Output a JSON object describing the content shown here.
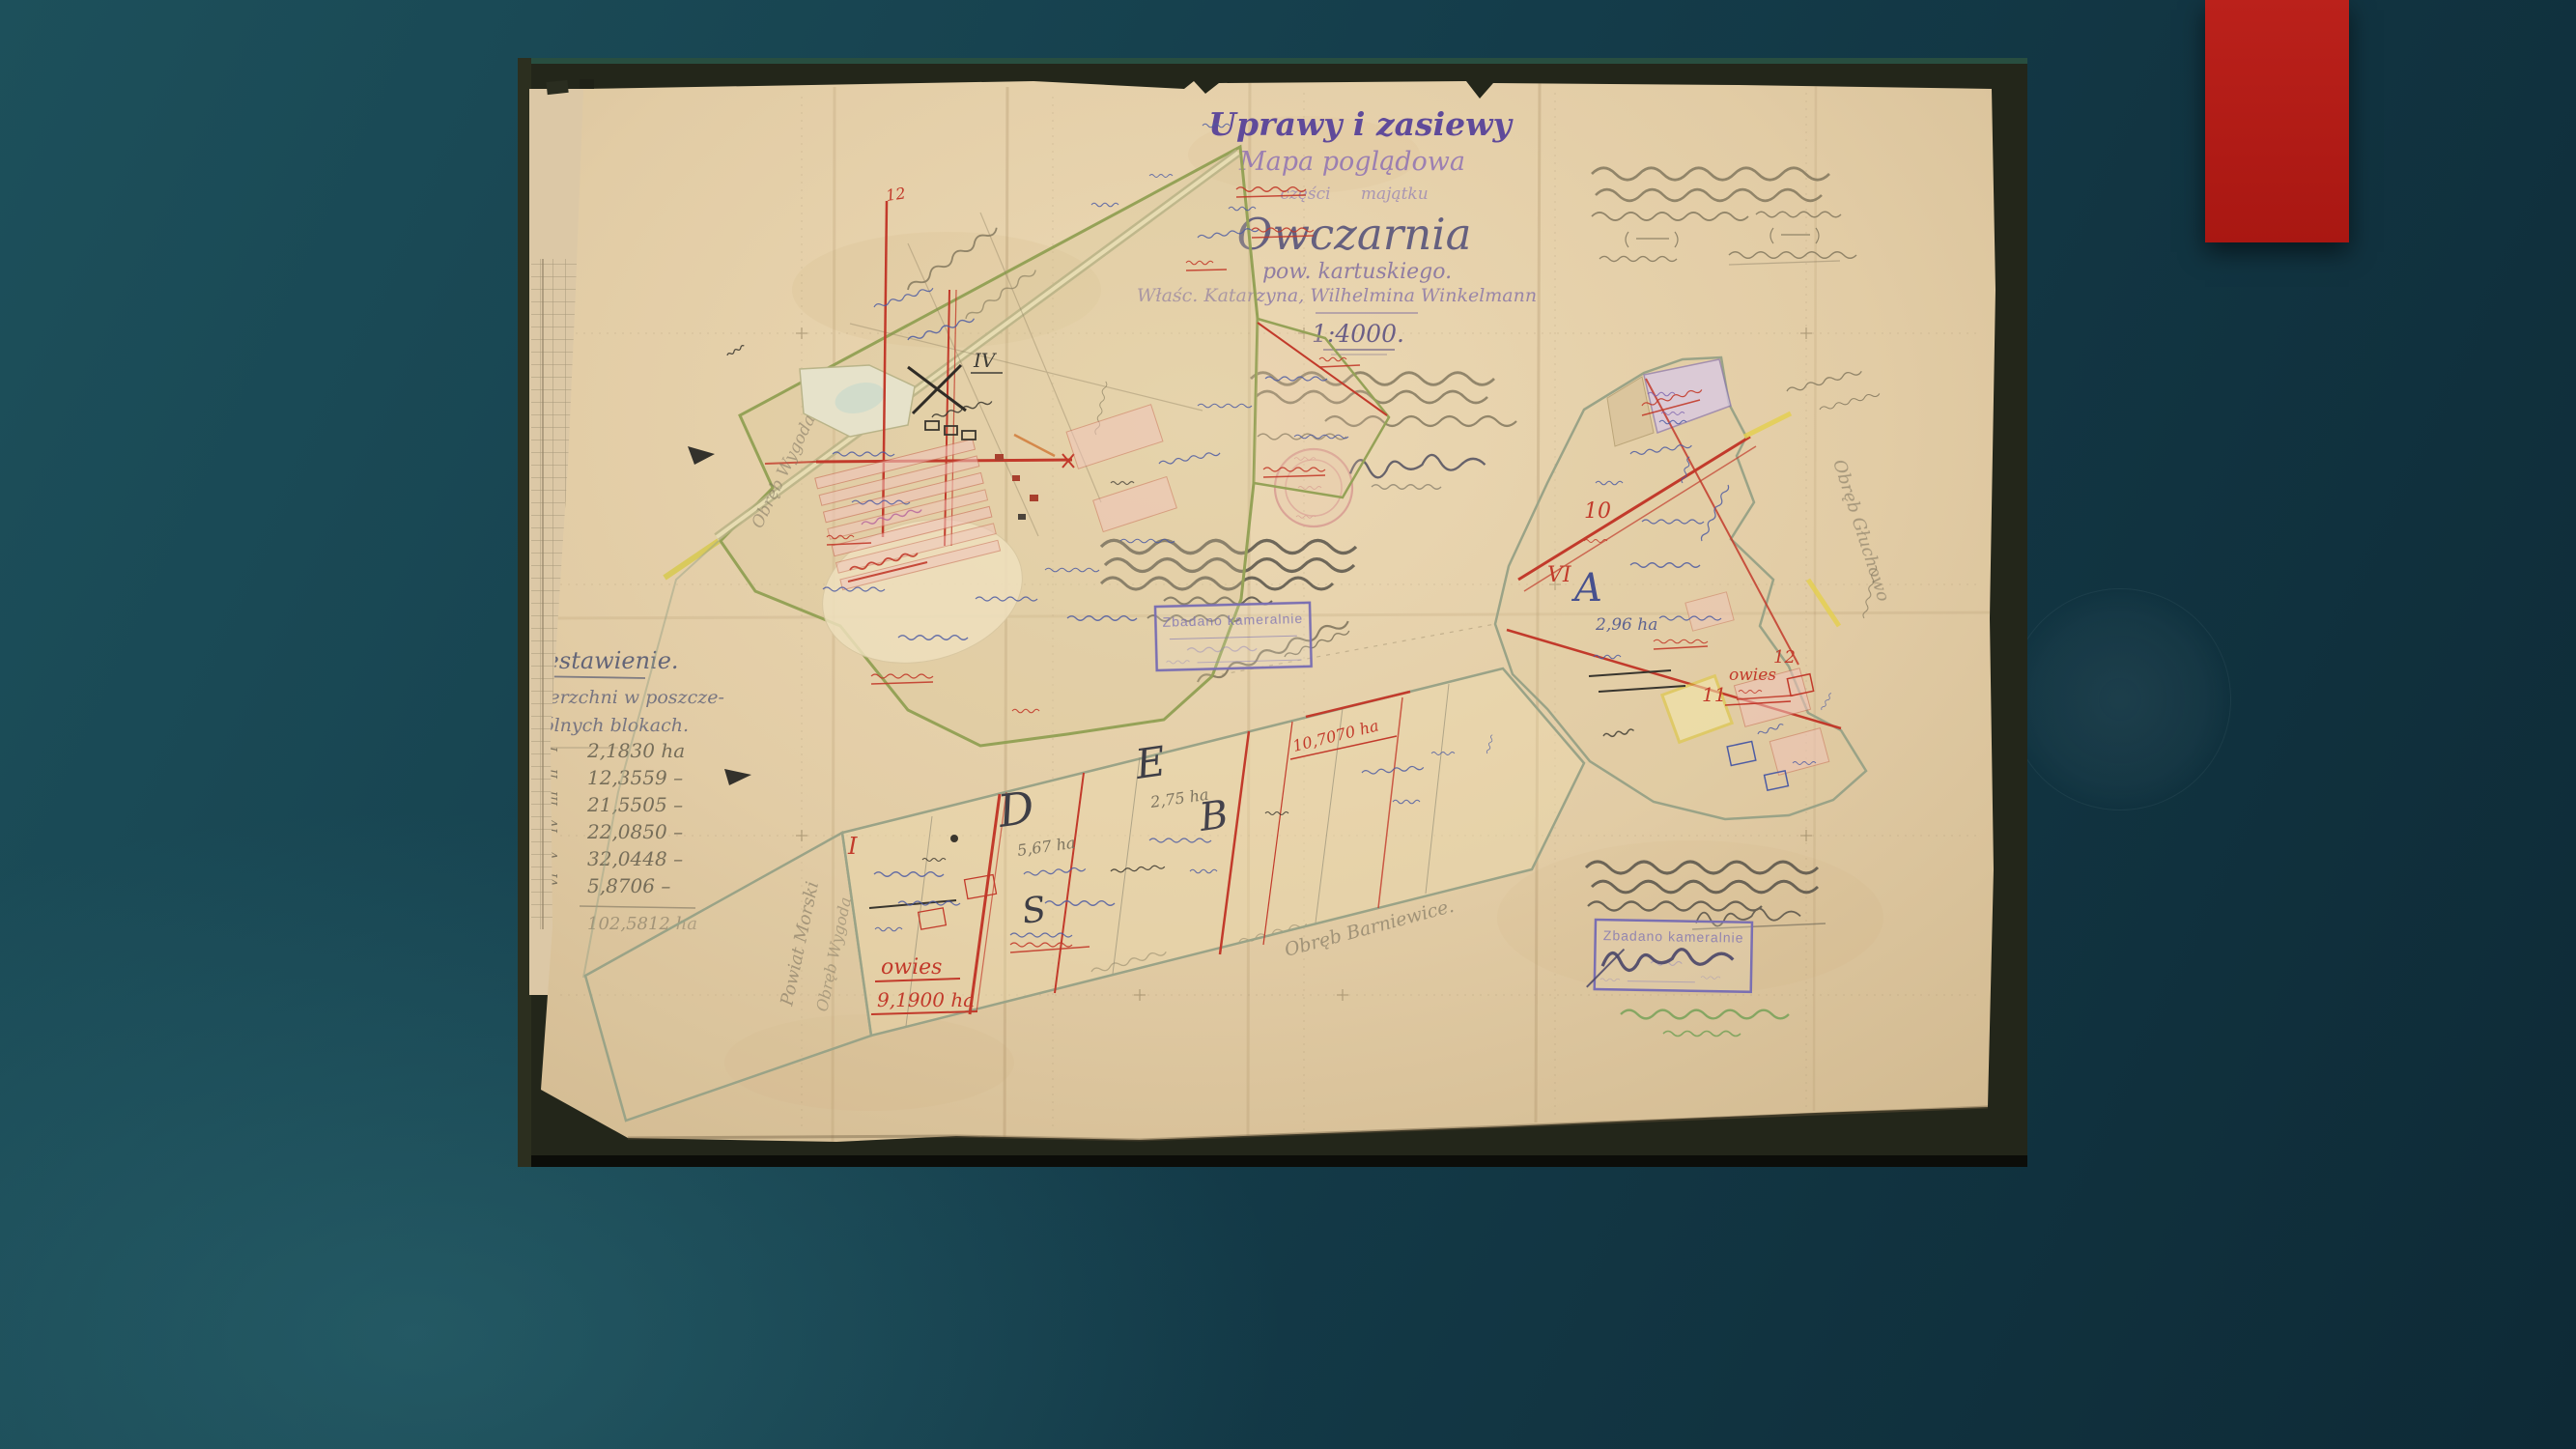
{
  "slide": {
    "background_top": "#0e2a36",
    "background_bottom": "#1d505b",
    "accent_color": "#b51d18"
  },
  "map": {
    "header": {
      "suptitle": "Uprawy i zasiewy",
      "subtitle": "Mapa poglądowa",
      "part_line": "części majątku",
      "estate_name": "Owczarnia",
      "district": "pow. kartuskiego.",
      "owners": "Właśc. Katarzyna, Wilhelmina Winkelmann",
      "scale": "1:4000."
    },
    "summary": {
      "title": "Zestawienie.",
      "line2": "wierzchni w poszcze-",
      "line3": "gólnych blokach.",
      "rows": [
        {
          "numeral": "I",
          "value": "2,1830 ha"
        },
        {
          "numeral": "II",
          "value": "12,3559 –"
        },
        {
          "numeral": "III",
          "value": "21,5505 –"
        },
        {
          "numeral": "IV",
          "value": "22,0850 –"
        },
        {
          "numeral": "V",
          "value": "32,0448 –"
        },
        {
          "numeral": "VI",
          "value": "5,8706 –"
        }
      ],
      "total": "102,5812 ha"
    },
    "stamp": {
      "title": "Zbadano kameralnie"
    },
    "parcels": {
      "i": "I",
      "d": "D",
      "d_area": "5,67 ha",
      "s": "S",
      "e": "E",
      "e_area": "2,75 ha",
      "b": "B",
      "a": "A",
      "a_area": "2,96 ha",
      "iv": "IV",
      "vi": "VI",
      "n10": "10",
      "n11": "11",
      "n12": "12",
      "nw12": "12"
    },
    "crops": {
      "owies_south": "owies",
      "owies_south_area": "9,1900 ha",
      "owies_east": "owies",
      "band_area": "10,7070 ha"
    },
    "places": {
      "wygoda": "Obręb Wygoda",
      "powiat": "Powiat Morski",
      "barniewice": "Obręb Barniewice.",
      "gluchowo": "Obręb Głuchowo"
    }
  }
}
